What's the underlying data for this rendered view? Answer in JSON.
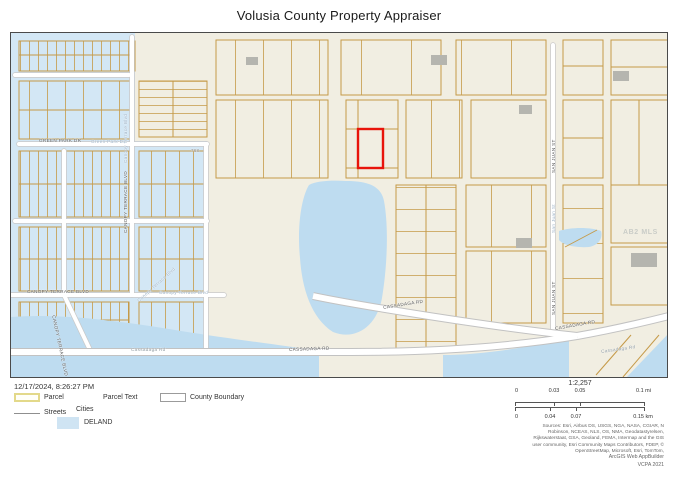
{
  "title": "Volusia County Property Appraiser",
  "map": {
    "labels": {
      "green_park_dark": "GREEN PARK DR",
      "green_park_light": "Green Park Dr",
      "canopy_vert_dark": "CANOPY TERRACE BLVD",
      "canopy_vert_light": "Canopy Terrace Blvd",
      "canopy_horiz_dark": "CANOPY TERRACE BLVD",
      "canopy_horiz_light": "Canopy Terrace Blvd",
      "canopy_diag_dark": "CANOPY TERRACE BLVD",
      "canopy_diag_light": "Canopy Terrace Blvd",
      "cassadaga_light_left": "Cassadaga Rd",
      "cassadaga_dark_mid": "CASSADAGA RD",
      "cassadaga_dark_upper": "CASSADAGA RD",
      "cassadaga_dark_right": "CASSADAGA RD",
      "cassadaga_light_right": "Cassadaga Rd",
      "san_juan_dark_upper": "SAN JUAN ST",
      "san_juan_light": "San Juan St",
      "san_juan_dark_lower": "SAN JUAN ST",
      "parcel_text_768": "768",
      "watermark": "AB2 MLS"
    },
    "colors": {
      "basemap": "#f1eee2",
      "city_deland_fill": "#d3e7f5",
      "water_fill": "#bedcf0",
      "parcel_line": "#c59a48",
      "selected_parcel": "#e8140b",
      "building_fill": "#b5b5af",
      "road_fill": "#ffffff",
      "road_casing": "#c2c2c2"
    }
  },
  "footer": {
    "timestamp": "12/17/2024, 8:26:27 PM",
    "legend": {
      "parcel": "Parcel",
      "parcel_text": "Parcel Text",
      "county_boundary": "County Boundary",
      "streets": "Streets",
      "cities": "Cities",
      "deland": "DELAND"
    },
    "scale": {
      "ratio": "1:2,257",
      "mi_ticks": [
        "0",
        "0.03",
        "0.05",
        "0.1 mi"
      ],
      "km_ticks": [
        "0",
        "0.04",
        "0.07",
        "0.15 km"
      ]
    },
    "credits": {
      "sources": "Sources: Esri, Airbus DS, USGS, NGA, NASA, CGIAR, N Robinson, NCEAS, NLS, OS, NMA, Geodatastyrelsen, Rijkswaterstaat, GSA, Geoland, FEMA, Intermap and the GIS user community, Esri Community Maps Contributors, FDEP, © OpenStreetMap, Microsoft, Esri, TomTom,",
      "app": "ArcGIS Web AppBuilder",
      "org": "VCPA 2021"
    }
  }
}
